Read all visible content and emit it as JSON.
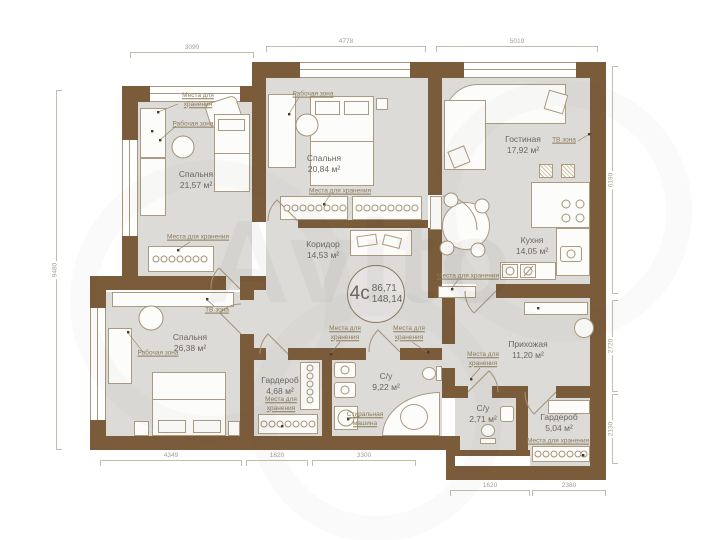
{
  "unit": {
    "type_label": "4с",
    "living_area": "86,71",
    "total_area": "148,14"
  },
  "rooms": {
    "bedroom1": {
      "name": "Спальня",
      "area": "21,57 м²"
    },
    "bedroom2": {
      "name": "Спальня",
      "area": "20,84 м²"
    },
    "living": {
      "name": "Гостиная",
      "area": "17,92 м²"
    },
    "kitchen": {
      "name": "Кухня",
      "area": "14,05 м²"
    },
    "corridor": {
      "name": "Коридор",
      "area": "14,53 м²"
    },
    "bedroom3": {
      "name": "Спальня",
      "area": "26,38 м²"
    },
    "wardrobe1": {
      "name": "Гардероб",
      "area": "4,68 м²"
    },
    "bathroom1": {
      "name": "С/у",
      "area": "9,22 м²"
    },
    "hallway": {
      "name": "Прихожая",
      "area": "11,20 м²"
    },
    "bathroom2": {
      "name": "С/у",
      "area": "2,71 м²"
    },
    "wardrobe2": {
      "name": "Гардероб",
      "area": "5,04 м²"
    }
  },
  "labels": {
    "storage": "Места для хранения",
    "work": "Рабочая зона",
    "tv": "ТВ зона",
    "washer": "Стиральная машина"
  },
  "dimensions": {
    "top": [
      "3090",
      "4778",
      "5019"
    ],
    "right": [
      "6190",
      "2720",
      "2130"
    ],
    "bottom_upper": [
      "4349",
      "1820",
      "3300"
    ],
    "bottom_lower": [
      "1620",
      "2380"
    ],
    "left": [
      "9480"
    ]
  },
  "watermark": "Avito",
  "colors": {
    "wall": "#7a5b3a",
    "floor": "#dcdbd8",
    "furniture_outline": "#ac9b80",
    "dimension": "#a59e93",
    "zone_label": "#8c7b5a",
    "room_label": "#6b665d"
  }
}
